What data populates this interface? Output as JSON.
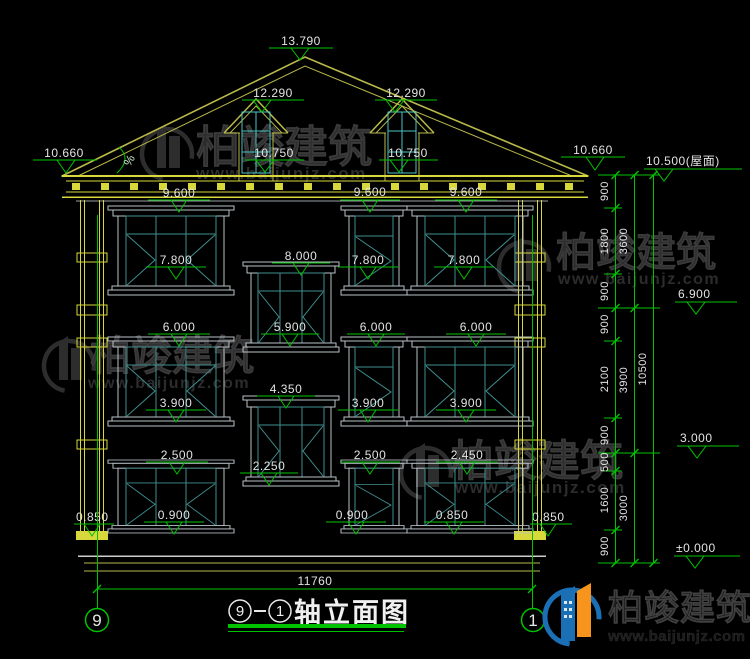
{
  "title": {
    "axis_start": "9",
    "axis_end": "1",
    "label": "轴立面图"
  },
  "axes": {
    "left": "9",
    "right": "1"
  },
  "dimensions": {
    "overall_width": "11760",
    "chain_inner": [
      "900",
      "1800",
      "900",
      "900",
      "2100",
      "900",
      "500",
      "1600",
      "900"
    ],
    "chain_mid": [
      "3600",
      "3900",
      "3000"
    ],
    "chain_outer": [
      "10500"
    ]
  },
  "levels": {
    "ridge": "13.790",
    "dormer_left": "12.290",
    "dormer_right": "12.290",
    "dormer_sill_left": "10.750",
    "dormer_sill_right": "10.750",
    "eave_left": "10.660",
    "eave_right": "10.660",
    "roof_right": "10.500(屋面)",
    "floor3": "6.900",
    "floor2": "3.000",
    "ground": "±0.000",
    "plinth_left": "0.850",
    "plinth_right": "0.850"
  },
  "window_labels": {
    "f3_left_head": "9.600",
    "f3_left_sill": "7.800",
    "f3_mid_head": "9.600",
    "f3_mid_sill": "7.800",
    "f3_right_head": "9.600",
    "f3_right_sill": "7.800",
    "stair_upper_head": "8.000",
    "stair_upper_sill": "5.900",
    "stair_lower_head": "4.350",
    "stair_lower_sill": "2.250",
    "f2_left_head": "6.000",
    "f2_left_sill": "3.900",
    "f2_mid_head": "6.000",
    "f2_mid_sill": "3.900",
    "f2_right_head": "6.000",
    "f2_right_sill": "3.900",
    "f1_left_head": "2.500",
    "f1_left_sill": "0.900",
    "f1_mid_head": "2.500",
    "f1_mid_sill": "0.900",
    "f1_right_head": "2.450",
    "f1_right_sill": "0.850"
  },
  "roof": {
    "slope_symbol": "%"
  },
  "watermark": {
    "brand": "柏竣建筑",
    "url": "www.baijunjz.com"
  },
  "logo": {
    "brand": "柏竣建筑",
    "url": "www.baijunjz.com"
  },
  "colors": {
    "background": "#000000",
    "cad_green": "#00c300",
    "cad_yellow": "#d8d83c",
    "cad_olive": "#b9b94a",
    "window_gray": "#b9c2c9",
    "window_teal": "#3f8f8f",
    "dormer_cyan": "#4cc3c3",
    "text": "#e3e3e3",
    "watermark": "#2c2c2c",
    "logo_blue": "#1a6fb5",
    "logo_orange": "#f7941d"
  }
}
